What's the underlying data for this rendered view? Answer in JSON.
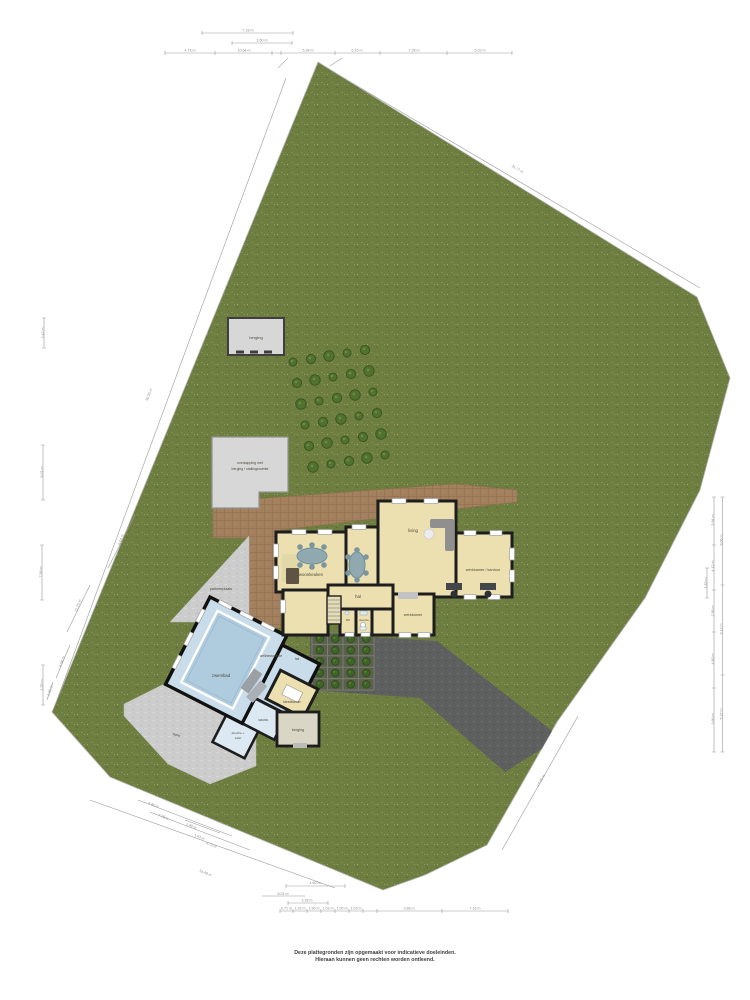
{
  "disclaimer": {
    "line1": "Deze plattegronden zijn opgemaakt voor indicatieve doeleinden.",
    "line2": "Hieraan kunnen geen rechten worden ontleend."
  },
  "colors": {
    "grass": "#6e7e41",
    "driveway": "#5e5f5f",
    "terrace": "#a3805e",
    "paving": "#cccccc",
    "house_floor": "#ecdfb0",
    "pool_water": "#afccdf",
    "pool_floor": "#c8dcea",
    "wall": "#1d1d1d"
  },
  "room_labels": [
    {
      "x": 311,
      "y": 576,
      "t": "woonkeuken"
    },
    {
      "x": 413,
      "y": 532,
      "t": "living"
    },
    {
      "x": 483,
      "y": 571,
      "t": "werkkamer / kantoor",
      "fs": 3.8
    },
    {
      "x": 358,
      "y": 598,
      "t": "hal"
    },
    {
      "x": 413,
      "y": 616,
      "t": "werkkamer",
      "fs": 3.8
    },
    {
      "x": 348,
      "y": 621,
      "t": "wc",
      "fs": 3.2
    },
    {
      "x": 364,
      "y": 621,
      "t": "douche",
      "fs": 3.0
    },
    {
      "x": 221,
      "y": 677,
      "t": "zwembad"
    },
    {
      "x": 271,
      "y": 657,
      "t": "wellnessruimte",
      "fs": 3.4
    },
    {
      "x": 297,
      "y": 660,
      "t": "hal",
      "fs": 3.4
    },
    {
      "x": 292,
      "y": 703,
      "t": "kleedkamer",
      "fs": 3.4
    },
    {
      "x": 263,
      "y": 721,
      "t": "sauna",
      "fs": 3.4
    },
    {
      "x": 238,
      "y": 734,
      "t": "douche +",
      "fs": 3.1
    },
    {
      "x": 238,
      "y": 739,
      "t": "toilet",
      "fs": 3.1
    },
    {
      "x": 298,
      "y": 731,
      "t": "berging",
      "fs": 3.7
    },
    {
      "x": 256,
      "y": 339,
      "t": "berging",
      "fs": 4.0
    },
    {
      "x": 250,
      "y": 464,
      "t": "overkapping met",
      "fs": 3.5
    },
    {
      "x": 250,
      "y": 470,
      "t": "berging / stallingsruimte",
      "fs": 3.5
    },
    {
      "x": 221,
      "y": 590,
      "t": "parkeerplaats",
      "fs": 3.7
    },
    {
      "x": 176,
      "y": 736,
      "t": "oprit",
      "fs": 3.8,
      "r": 20
    }
  ],
  "dim_labels": [
    {
      "x": 248,
      "y": 31.5,
      "r": 0,
      "t": "7.18 m"
    },
    {
      "x": 262,
      "y": 41.5,
      "r": 0,
      "t": "3.60 m"
    },
    {
      "x": 190,
      "y": 51.5,
      "r": 0,
      "t": "4.71 m"
    },
    {
      "x": 244,
      "y": 51.5,
      "r": 0,
      "t": "10.04 m"
    },
    {
      "x": 308,
      "y": 51.5,
      "r": 0,
      "t": "5.38 m"
    },
    {
      "x": 357,
      "y": 51.5,
      "r": 0,
      "t": "6.10 m"
    },
    {
      "x": 414,
      "y": 51.5,
      "r": 0,
      "t": "7.28 m"
    },
    {
      "x": 480,
      "y": 51.5,
      "r": 0,
      "t": "5.02 m"
    },
    {
      "x": 44,
      "y": 333,
      "r": -90,
      "t": "2.42 m"
    },
    {
      "x": 43,
      "y": 472,
      "r": -90,
      "t": "8.01 m"
    },
    {
      "x": 42,
      "y": 572,
      "r": -90,
      "t": "7.56 m"
    },
    {
      "x": 43,
      "y": 685,
      "r": -90,
      "t": "1.55 m"
    },
    {
      "x": 150,
      "y": 395,
      "r": -70,
      "t": "36.55 m"
    },
    {
      "x": 122,
      "y": 540,
      "r": -70,
      "t": "9.04 m"
    },
    {
      "x": 79,
      "y": 606,
      "r": -70,
      "t": "12.75 m"
    },
    {
      "x": 63,
      "y": 662,
      "r": -70,
      "t": "6.98 m"
    },
    {
      "x": 51,
      "y": 691,
      "r": -70,
      "t": "1.35 m"
    },
    {
      "x": 517,
      "y": 170,
      "r": 31,
      "t": "31.77 m"
    },
    {
      "x": 714,
      "y": 520,
      "r": -90,
      "t": "3.94 m"
    },
    {
      "x": 714,
      "y": 566,
      "r": -90,
      "t": "4.12 m"
    },
    {
      "x": 714,
      "y": 611,
      "r": -90,
      "t": "2.95 m"
    },
    {
      "x": 714,
      "y": 659,
      "r": -90,
      "t": "4.80 m"
    },
    {
      "x": 714,
      "y": 719,
      "r": -90,
      "t": "3.66 m"
    },
    {
      "x": 722.5,
      "y": 540,
      "r": -90,
      "t": "8.06 m"
    },
    {
      "x": 722.5,
      "y": 629,
      "r": -90,
      "t": "9.12 m"
    },
    {
      "x": 722.5,
      "y": 714,
      "r": -90,
      "t": "5.27 m"
    },
    {
      "x": 707,
      "y": 583,
      "r": -90,
      "t": "1.83 m"
    },
    {
      "x": 542,
      "y": 781,
      "r": -60,
      "t": "14.20 m"
    },
    {
      "x": 153,
      "y": 806,
      "r": 22,
      "t": "9.46 m"
    },
    {
      "x": 163,
      "y": 818,
      "r": 22,
      "t": "7.78 m"
    },
    {
      "x": 191,
      "y": 827,
      "r": 22,
      "t": "1.40 m"
    },
    {
      "x": 199,
      "y": 838,
      "r": 22,
      "t": "1.43 m"
    },
    {
      "x": 211,
      "y": 846,
      "r": 22,
      "t": "6.73 m"
    },
    {
      "x": 205,
      "y": 874,
      "r": 22,
      "t": "19.48 m"
    },
    {
      "x": 315,
      "y": 884,
      "r": 0,
      "t": "4.60 m"
    },
    {
      "x": 283,
      "y": 895,
      "r": 0,
      "t": "8.01 m"
    },
    {
      "x": 307,
      "y": 901.5,
      "r": 0,
      "t": "3.28 m"
    },
    {
      "x": 286.5,
      "y": 909.5,
      "r": 0,
      "t": "0.71 m"
    },
    {
      "x": 300,
      "y": 909.5,
      "r": 0,
      "t": "1.32 m"
    },
    {
      "x": 314,
      "y": 909.5,
      "r": 0,
      "t": "1.90 m"
    },
    {
      "x": 328,
      "y": 909.5,
      "r": 0,
      "t": "1.03 m"
    },
    {
      "x": 342,
      "y": 909.5,
      "r": 0,
      "t": "1.90 m"
    },
    {
      "x": 356,
      "y": 909.5,
      "r": 0,
      "t": "1.03 m"
    },
    {
      "x": 409,
      "y": 909.5,
      "r": 0,
      "t": "3.88 m"
    },
    {
      "x": 475,
      "y": 909.5,
      "r": 0,
      "t": "7.16 m"
    }
  ]
}
